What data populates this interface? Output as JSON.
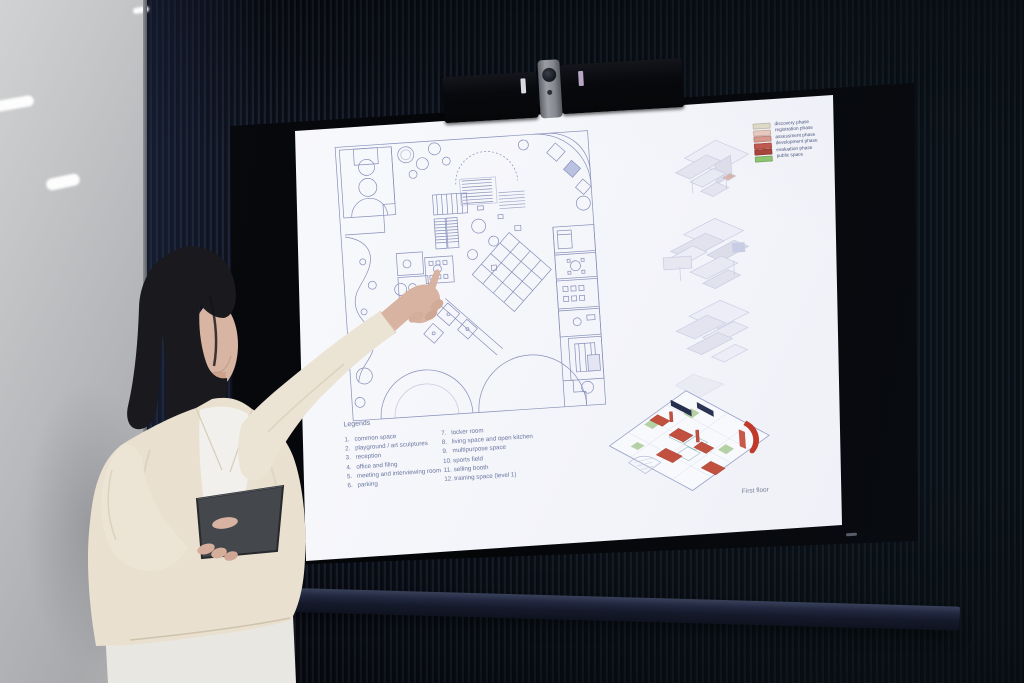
{
  "slide": {
    "legend": {
      "title": "Legends",
      "left": [
        {
          "num": "1.",
          "label": "common space"
        },
        {
          "num": "2.",
          "label": "playground / art sculptures"
        },
        {
          "num": "3.",
          "label": "reception"
        },
        {
          "num": "4.",
          "label": "office and filing"
        },
        {
          "num": "5.",
          "label": "meeting and interviewing room"
        },
        {
          "num": "6.",
          "label": "parking"
        }
      ],
      "right": [
        {
          "num": "7.",
          "label": "locker room"
        },
        {
          "num": "8.",
          "label": "living space and open kitchen"
        },
        {
          "num": "9.",
          "label": "multipurpose space"
        },
        {
          "num": "10.",
          "label": "sports field"
        },
        {
          "num": "11.",
          "label": "selling booth"
        },
        {
          "num": "12.",
          "label": "training space (level 1)"
        }
      ]
    },
    "phases": [
      {
        "label": "discovery phase",
        "color": "#ded8c6"
      },
      {
        "label": "registration phase",
        "color": "#e7c9bf"
      },
      {
        "label": "assessment phase",
        "color": "#d7998d"
      },
      {
        "label": "development phase",
        "color": "#c05a50"
      },
      {
        "label": "evaluation phase",
        "color": "#a8443c"
      },
      {
        "label": "public space",
        "color": "#8cc370"
      }
    ],
    "caption": "First floor"
  },
  "colors": {
    "wall": "#10141d",
    "screen_background": "#f5f6fa",
    "plan_linework": "#8089b6",
    "accent_red": "#c2503f",
    "accent_green": "#a9cb97"
  }
}
